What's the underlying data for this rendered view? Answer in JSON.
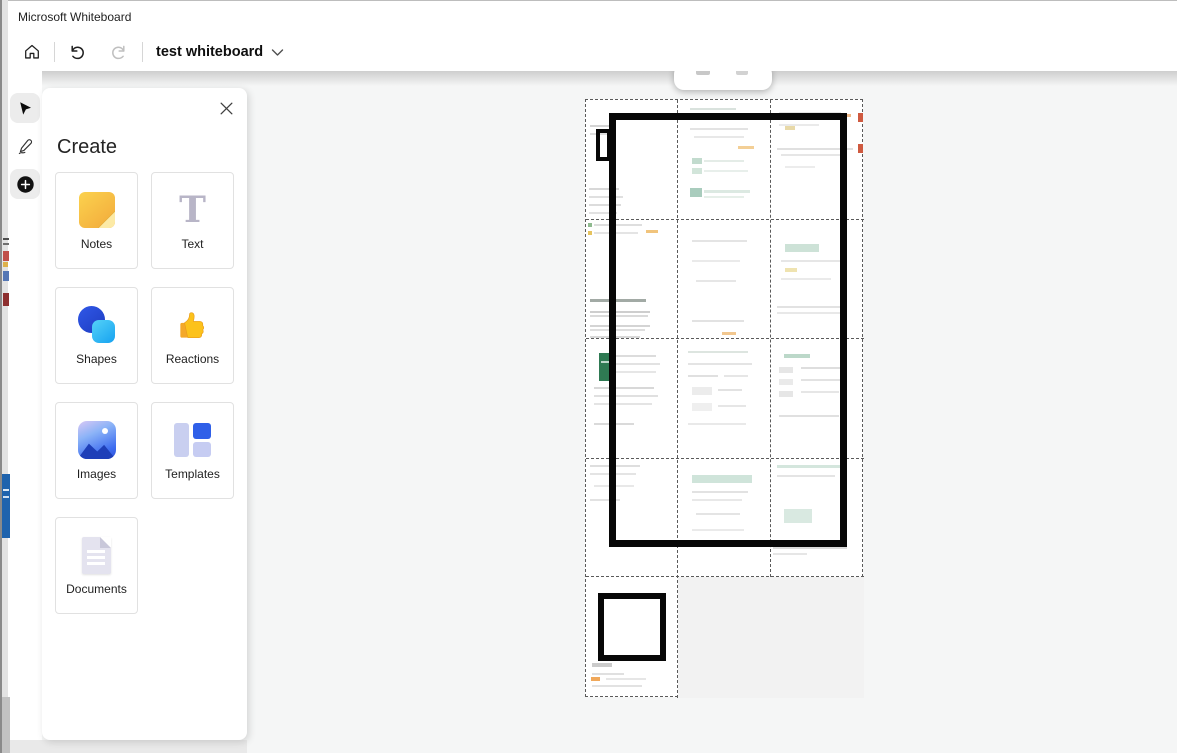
{
  "window": {
    "title": "Microsoft Whiteboard"
  },
  "toolbar": {
    "board_name": "test whiteboard",
    "home_icon": "home-icon",
    "undo_icon": "undo-icon",
    "redo_icon": "redo-icon",
    "dropdown_icon": "chevron-down-icon",
    "undo_enabled_color": "#1f1f1f",
    "redo_disabled_color": "#bfbfbf"
  },
  "tool_rail": {
    "tools": [
      {
        "id": "select",
        "icon": "cursor-arrow-icon",
        "selected": true
      },
      {
        "id": "ink",
        "icon": "pen-icon",
        "selected": false
      },
      {
        "id": "add",
        "icon": "plus-icon",
        "selected": true
      }
    ],
    "selected_bg": "#ececec"
  },
  "create_panel": {
    "title": "Create",
    "close_icon": "close-icon",
    "items": [
      {
        "label": "Notes",
        "icon": "sticky-note-icon",
        "color": "#f2a93b"
      },
      {
        "label": "Text",
        "icon": "text-icon",
        "color": "#b8b5c7"
      },
      {
        "label": "Shapes",
        "icon": "shapes-icon",
        "color": "#2b50d8"
      },
      {
        "label": "Reactions",
        "icon": "thumbs-up-icon",
        "color": "#fbbf24"
      },
      {
        "label": "Images",
        "icon": "image-icon",
        "color": "#3d6cf0"
      },
      {
        "label": "Templates",
        "icon": "templates-icon",
        "color": "#2f5fe8"
      },
      {
        "label": "Documents",
        "icon": "document-icon",
        "color": "#e4e3ef"
      }
    ]
  },
  "canvas": {
    "background": "#f5f6f6",
    "ink_color": "#070707",
    "excel_green": "#2f7a53",
    "grid": {
      "x": 585,
      "y": 99,
      "w": 278,
      "h": 598,
      "dividers": [
        {
          "o": "h",
          "x": 0,
          "y": 120,
          "len": 278
        },
        {
          "o": "h",
          "x": 0,
          "y": 239,
          "len": 278
        },
        {
          "o": "h",
          "x": 0,
          "y": 359,
          "len": 278
        },
        {
          "o": "h",
          "x": 0,
          "y": 477,
          "len": 278
        },
        {
          "o": "v",
          "x": 92,
          "y": 0,
          "len": 598
        },
        {
          "o": "v",
          "x": 185,
          "y": 0,
          "len": 477
        }
      ],
      "cells": [
        {
          "id": "r1c1",
          "x": 0,
          "y": 0,
          "w": 92,
          "h": 120,
          "marks": [
            [
              4,
              25,
              20,
              2,
              "#d4d4d4"
            ],
            [
              4,
              33,
              26,
              2,
              "#dedede"
            ],
            [
              3,
              88,
              30,
              2,
              "#d8d8d8"
            ],
            [
              3,
              96,
              34,
              2,
              "#e0e0e0"
            ],
            [
              3,
              104,
              32,
              2,
              "#dcdcdc"
            ],
            [
              3,
              112,
              28,
              2,
              "#e2e2e2"
            ]
          ]
        },
        {
          "id": "r1c2",
          "x": 92,
          "y": 0,
          "w": 93,
          "h": 120,
          "marks": [
            [
              12,
              8,
              46,
              2,
              "#d9e2dd"
            ],
            [
              12,
              28,
              58,
              2,
              "#e3e3e3"
            ],
            [
              16,
              36,
              50,
              2,
              "#e8e8e8"
            ],
            [
              60,
              46,
              16,
              3,
              "#f3cf96"
            ],
            [
              14,
              58,
              10,
              6,
              "#c2dbce"
            ],
            [
              26,
              60,
              40,
              2,
              "#e4ece7"
            ],
            [
              14,
              68,
              10,
              6,
              "#d2e5da"
            ],
            [
              26,
              70,
              44,
              2,
              "#e8efeb"
            ],
            [
              12,
              88,
              12,
              9,
              "#a9ccbd"
            ],
            [
              26,
              90,
              46,
              3,
              "#dce9e2"
            ],
            [
              26,
              96,
              40,
              2,
              "#e6efe9"
            ]
          ]
        },
        {
          "id": "r1c3",
          "x": 185,
          "y": 0,
          "w": 93,
          "h": 120,
          "marks": [
            [
              8,
              12,
              62,
              2,
              "#e4e4e4"
            ],
            [
              72,
              14,
              8,
              3,
              "#f0b988"
            ],
            [
              87,
              13,
              5,
              9,
              "#cf5a40"
            ],
            [
              8,
              24,
              40,
              2,
              "#eaeaea"
            ],
            [
              14,
              26,
              10,
              4,
              "#e8d9a8"
            ],
            [
              6,
              48,
              76,
              2,
              "#e0e0e0"
            ],
            [
              87,
              44,
              5,
              9,
              "#cf5a40"
            ],
            [
              10,
              54,
              66,
              2,
              "#e6e6e6"
            ],
            [
              14,
              66,
              30,
              2,
              "#ececec"
            ]
          ]
        },
        {
          "id": "r2c1",
          "x": 0,
          "y": 120,
          "w": 92,
          "h": 119,
          "marks": [
            [
              2,
              3,
              4,
              4,
              "#8fba8f"
            ],
            [
              2,
              11,
              4,
              4,
              "#e6c35e"
            ],
            [
              8,
              4,
              48,
              2,
              "#dedede"
            ],
            [
              8,
              12,
              44,
              2,
              "#e4e4e4"
            ],
            [
              60,
              10,
              12,
              3,
              "#f1c47c"
            ],
            [
              4,
              79,
              56,
              3,
              "#a2aaa5"
            ],
            [
              4,
              91,
              60,
              2,
              "#cecece"
            ],
            [
              4,
              95,
              58,
              2,
              "#dadada"
            ],
            [
              4,
              105,
              60,
              2,
              "#d4d4d4"
            ],
            [
              4,
              109,
              55,
              2,
              "#dedede"
            ],
            [
              4,
              116,
              50,
              2,
              "#d9d9d9"
            ]
          ]
        },
        {
          "id": "r2c2",
          "x": 92,
          "y": 120,
          "w": 93,
          "h": 119,
          "marks": [
            [
              14,
              20,
              55,
              2,
              "#e4e4e4"
            ],
            [
              14,
              40,
              48,
              2,
              "#eaeaea"
            ],
            [
              18,
              60,
              40,
              2,
              "#e6e6e6"
            ],
            [
              14,
              100,
              52,
              2,
              "#e2e2e2"
            ],
            [
              44,
              112,
              14,
              3,
              "#f2c78f"
            ]
          ]
        },
        {
          "id": "r2c3",
          "x": 185,
          "y": 120,
          "w": 93,
          "h": 119,
          "marks": [
            [
              14,
              24,
              34,
              8,
              "#cde2d7"
            ],
            [
              10,
              40,
              60,
              2,
              "#e6e6e6"
            ],
            [
              14,
              48,
              12,
              4,
              "#efe3b0"
            ],
            [
              10,
              58,
              50,
              2,
              "#eaeaea"
            ],
            [
              6,
              86,
              70,
              2,
              "#e2e2e2"
            ],
            [
              6,
              92,
              64,
              2,
              "#e8e8e8"
            ]
          ]
        },
        {
          "id": "r3c1",
          "x": 0,
          "y": 239,
          "w": 92,
          "h": 120,
          "marks": [
            [
              13,
              14,
              12,
              28,
              "#2f7a53"
            ],
            [
              15,
              22,
              8,
              2,
              "#bed8cb"
            ],
            [
              30,
              16,
              40,
              2,
              "#dcdcdc"
            ],
            [
              30,
              24,
              44,
              2,
              "#e2e2e2"
            ],
            [
              30,
              32,
              40,
              2,
              "#e6e6e6"
            ],
            [
              8,
              48,
              60,
              2,
              "#d8d8d8"
            ],
            [
              8,
              56,
              64,
              2,
              "#e0e0e0"
            ],
            [
              8,
              64,
              58,
              2,
              "#e4e4e4"
            ],
            [
              8,
              84,
              40,
              2,
              "#dadada"
            ]
          ]
        },
        {
          "id": "r3c2",
          "x": 92,
          "y": 239,
          "w": 93,
          "h": 120,
          "marks": [
            [
              10,
              12,
              60,
              2,
              "#dde5e0"
            ],
            [
              10,
              24,
              64,
              2,
              "#e4e4e4"
            ],
            [
              10,
              36,
              30,
              2,
              "#e0e0e0"
            ],
            [
              46,
              36,
              24,
              2,
              "#e6e6e6"
            ],
            [
              14,
              48,
              20,
              8,
              "#ececec"
            ],
            [
              40,
              50,
              24,
              2,
              "#e2e2e2"
            ],
            [
              14,
              64,
              20,
              8,
              "#efefef"
            ],
            [
              40,
              66,
              28,
              2,
              "#e6e6e6"
            ],
            [
              10,
              84,
              58,
              2,
              "#e9e9e9"
            ]
          ]
        },
        {
          "id": "r3c3",
          "x": 185,
          "y": 239,
          "w": 93,
          "h": 120,
          "marks": [
            [
              13,
              15,
              26,
              4,
              "#bcd8c9"
            ],
            [
              8,
              28,
              14,
              6,
              "#e6e6e6"
            ],
            [
              30,
              28,
              40,
              2,
              "#dedede"
            ],
            [
              8,
              40,
              14,
              6,
              "#eaeaea"
            ],
            [
              30,
              40,
              44,
              2,
              "#e2e2e2"
            ],
            [
              8,
              52,
              14,
              6,
              "#e6e6e6"
            ],
            [
              30,
              52,
              38,
              2,
              "#e6e6e6"
            ],
            [
              8,
              76,
              60,
              2,
              "#e0e0e0"
            ]
          ]
        },
        {
          "id": "r4c1",
          "x": 0,
          "y": 359,
          "w": 92,
          "h": 118,
          "marks": [
            [
              4,
              6,
              50,
              2,
              "#dedede"
            ],
            [
              4,
              14,
              46,
              2,
              "#e4e4e4"
            ],
            [
              8,
              26,
              40,
              2,
              "#e8e8e8"
            ],
            [
              4,
              40,
              30,
              2,
              "#e2e2e2"
            ]
          ]
        },
        {
          "id": "r4c2",
          "x": 92,
          "y": 359,
          "w": 93,
          "h": 118,
          "marks": [
            [
              14,
              16,
              60,
              8,
              "#cfe4da"
            ],
            [
              14,
              32,
              56,
              2,
              "#e2e2e2"
            ],
            [
              14,
              40,
              50,
              2,
              "#e8e8e8"
            ],
            [
              18,
              54,
              44,
              2,
              "#e4e4e4"
            ],
            [
              14,
              70,
              52,
              2,
              "#eaeaea"
            ]
          ]
        },
        {
          "id": "r4c3",
          "x": 185,
          "y": 359,
          "w": 93,
          "h": 118,
          "marks": [
            [
              6,
              6,
              64,
              3,
              "#d4e6dd"
            ],
            [
              6,
              16,
              58,
              2,
              "#e4e4e4"
            ],
            [
              13,
              50,
              28,
              14,
              "#d9e9e1"
            ],
            [
              2,
              88,
              74,
              2,
              "#dcdcdc"
            ],
            [
              2,
              94,
              34,
              2,
              "#e6e6e6"
            ]
          ]
        },
        {
          "id": "r5c1",
          "x": 0,
          "y": 477,
          "w": 92,
          "h": 121,
          "marks": [
            [
              6,
              86,
              20,
              4,
              "#cbcbcb"
            ],
            [
              6,
              96,
              32,
              2,
              "#e0e0e0"
            ],
            [
              5,
              100,
              9,
              4,
              "#f0a85a"
            ],
            [
              20,
              101,
              40,
              2,
              "#e6e6e6"
            ],
            [
              6,
              108,
              50,
              2,
              "#e2e2e2"
            ]
          ]
        },
        {
          "id": "r5c2-empty",
          "x": 92,
          "y": 477,
          "w": 186,
          "h": 121,
          "bg": "#f2f2f2",
          "marks": []
        }
      ]
    },
    "ink_strokes": [
      {
        "id": "large-rectangle",
        "x": 609,
        "y": 113,
        "w": 238,
        "h": 434,
        "stroke": 7
      },
      {
        "id": "small-rectangle-top",
        "x": 596,
        "y": 129,
        "w": 15,
        "h": 32,
        "stroke": 4
      },
      {
        "id": "small-square-bottom",
        "x": 598,
        "y": 593,
        "w": 68,
        "h": 68,
        "stroke": 6
      }
    ],
    "mini_toolbar": {
      "x": 674,
      "y": 64,
      "w": 98,
      "h": 26,
      "marks": [
        [
          22,
          4,
          14,
          7,
          "#c8c8c8"
        ],
        [
          62,
          4,
          12,
          7,
          "#d2d2d2"
        ]
      ]
    }
  },
  "background_window": {
    "fragments": [
      [
        1,
        238,
        6,
        2,
        "#4f4f4f"
      ],
      [
        1,
        243,
        6,
        2,
        "#6f6f6f"
      ],
      [
        1,
        251,
        6,
        10,
        "#c0504a"
      ],
      [
        1,
        262,
        5,
        5,
        "#ddb04a"
      ],
      [
        1,
        271,
        6,
        10,
        "#5577b5"
      ],
      [
        1,
        293,
        6,
        13,
        "#8e3030"
      ],
      [
        0,
        474,
        8,
        64,
        "#1f63ad"
      ],
      [
        1,
        489,
        6,
        2,
        "#dce8f5"
      ],
      [
        1,
        496,
        6,
        2,
        "#cfe0f2"
      ]
    ]
  }
}
